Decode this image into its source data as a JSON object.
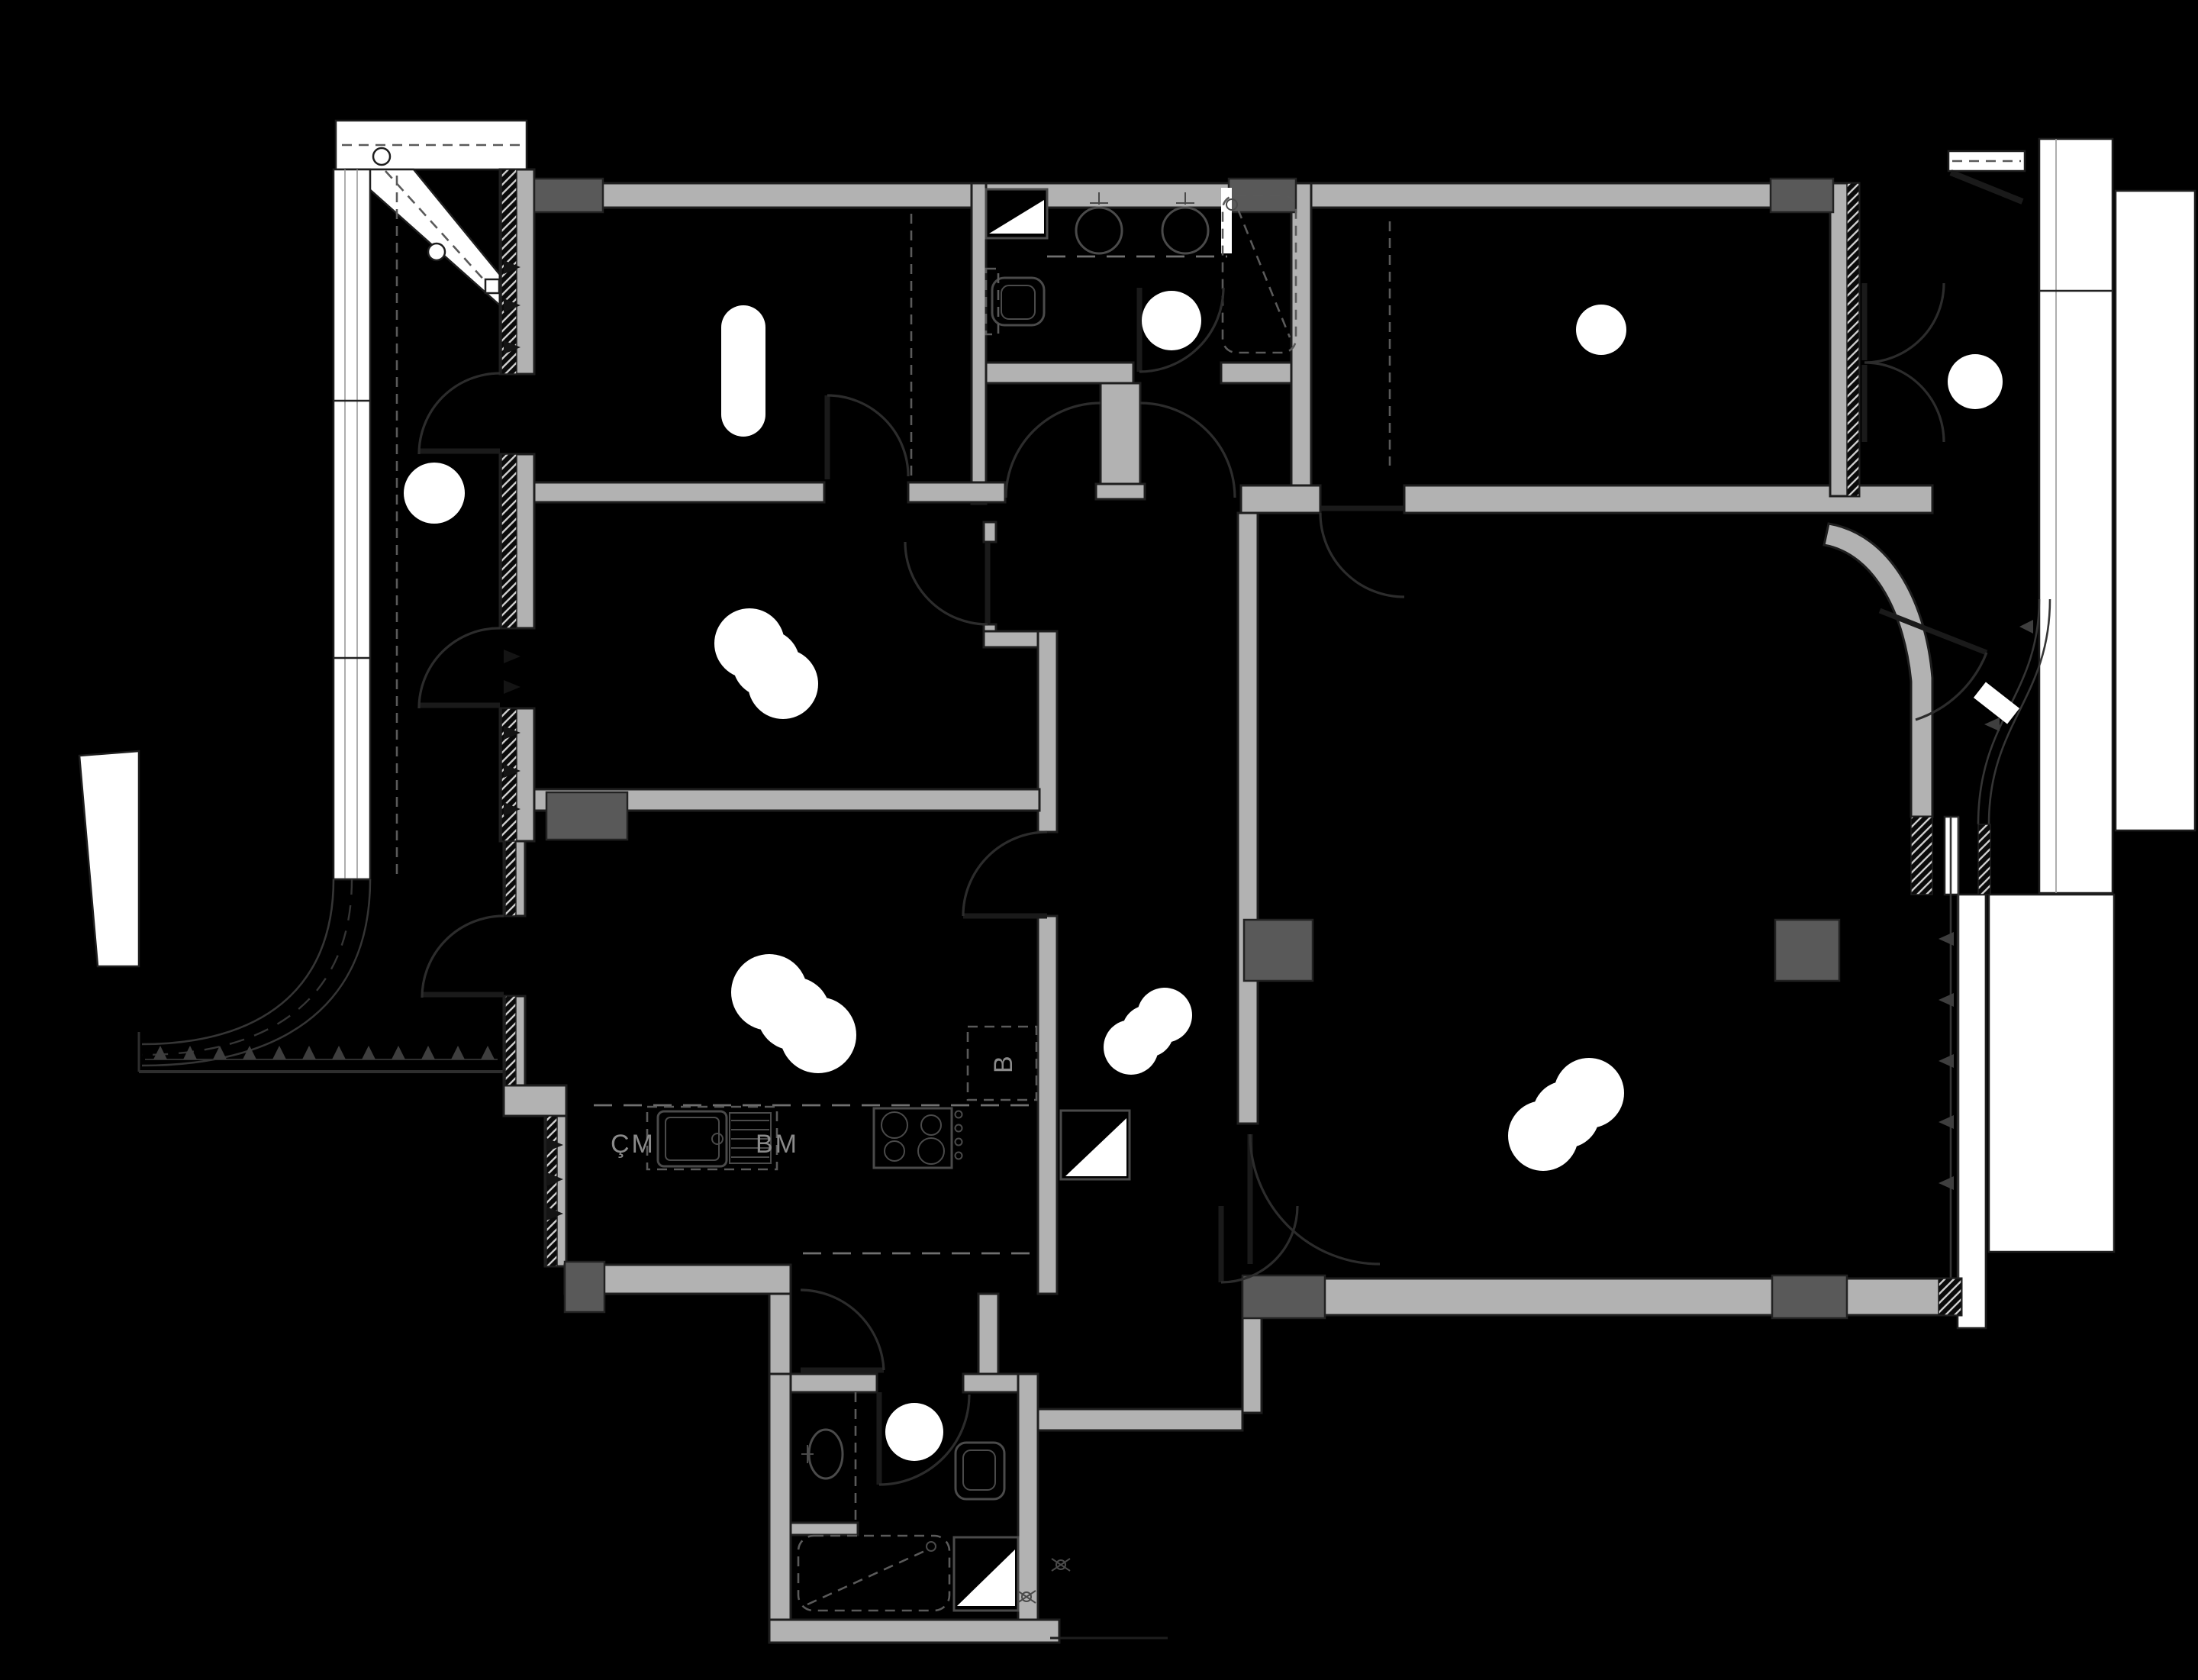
{
  "document": {
    "type": "architectural-floor-plan",
    "style": "dark-presentation-plan"
  },
  "labels": {
    "washing_machine": "ÇM",
    "dishwasher": "BM",
    "fridge": "B"
  },
  "colors": {
    "background": "#000000",
    "wall_fill": "#b2b2b2",
    "column_fill": "#595959",
    "wall_outline": "#1e1e1e",
    "fixture_line": "#4a4a4a",
    "door_line": "#2c2c2c",
    "glazing_white": "#ffffff",
    "label_text": "#8a8a8a"
  }
}
